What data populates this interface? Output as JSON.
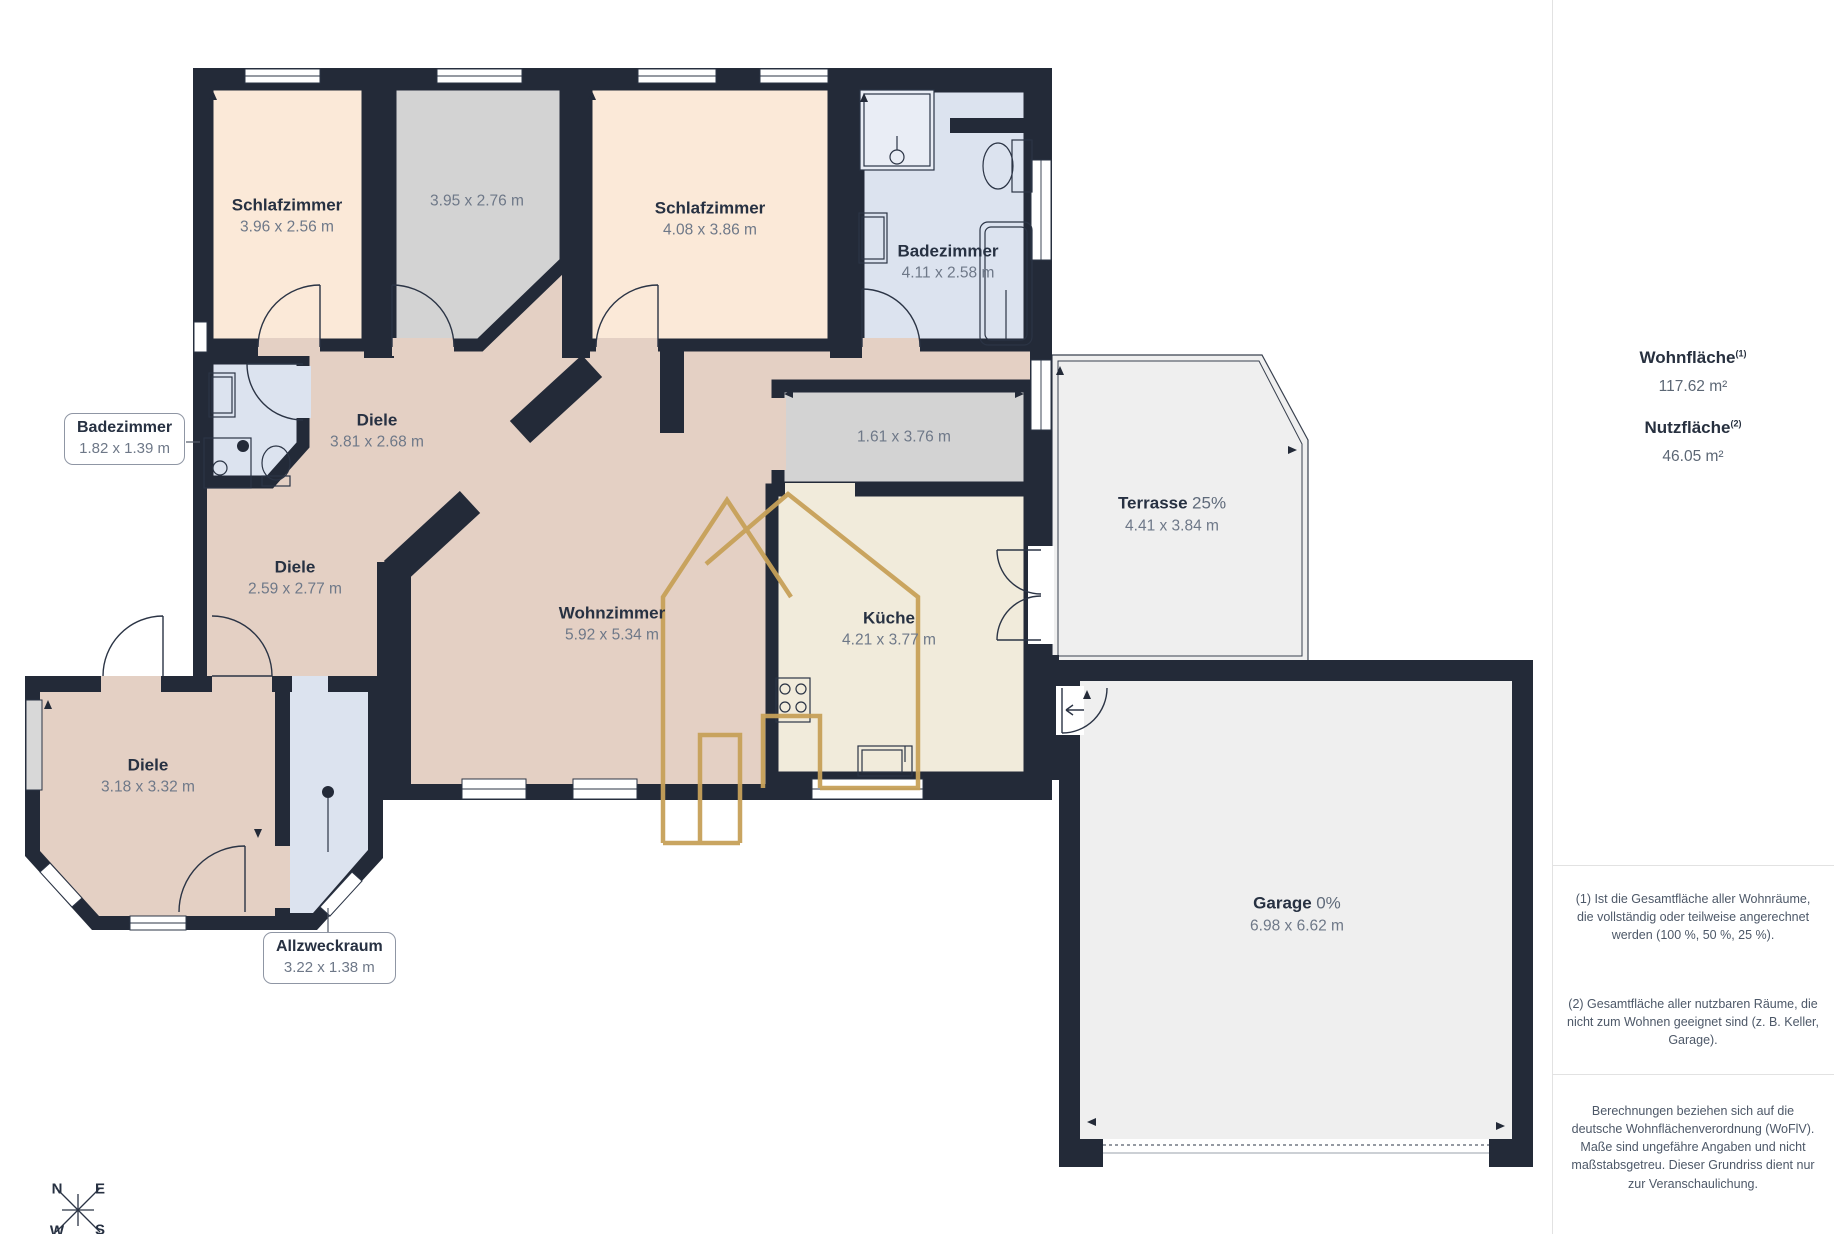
{
  "rooms": [
    {
      "id": "schlafzimmer-1",
      "name": "Schlafzimmer",
      "dims": "3.96 x 2.56 m"
    },
    {
      "id": "raum-oben",
      "name": "",
      "dims": "3.95 x 2.76 m"
    },
    {
      "id": "schlafzimmer-2",
      "name": "Schlafzimmer",
      "dims": "4.08 x 3.86 m"
    },
    {
      "id": "badezimmer-gross",
      "name": "Badezimmer",
      "dims": "4.11 x 2.58 m"
    },
    {
      "id": "badezimmer-klein",
      "name": "Badezimmer",
      "dims": "1.82 x 1.39 m"
    },
    {
      "id": "diele-1",
      "name": "Diele",
      "dims": "3.81 x 2.68 m"
    },
    {
      "id": "diele-2",
      "name": "Diele",
      "dims": "2.59 x 2.77 m"
    },
    {
      "id": "raum-mitte",
      "name": "",
      "dims": "1.61 x 3.76 m"
    },
    {
      "id": "terrasse",
      "name": "Terrasse",
      "pct": "25%",
      "dims": "4.41 x 3.84 m"
    },
    {
      "id": "wohnzimmer",
      "name": "Wohnzimmer",
      "dims": "5.92 x 5.34 m"
    },
    {
      "id": "kueche",
      "name": "Küche",
      "dims": "4.21 x 3.77 m"
    },
    {
      "id": "diele-3",
      "name": "Diele",
      "dims": "3.18 x 3.32 m"
    },
    {
      "id": "allzweckraum",
      "name": "Allzweckraum",
      "dims": "3.22 x 1.38 m"
    },
    {
      "id": "garage",
      "name": "Garage",
      "pct": "0%",
      "dims": "6.98 x 6.62 m"
    }
  ],
  "sidebar": {
    "wohnflaeche_label": "Wohnfläche",
    "wohnflaeche_sup": "(1)",
    "wohnflaeche_value": "117.62 m²",
    "nutzflaeche_label": "Nutzfläche",
    "nutzflaeche_sup": "(2)",
    "nutzflaeche_value": "46.05 m²",
    "footnote1": "(1) Ist die Gesamtfläche aller Wohnräume, die vollständig oder teilweise angerechnet werden (100 %, 50 %, 25 %).",
    "footnote2": "(2) Gesamtfläche aller nutzbaren Räume, die nicht zum Wohnen geeignet sind (z. B. Keller, Garage).",
    "disclaimer": "Berechnungen beziehen sich auf die deutsche Wohnflächenverordnung (WoFlV). Maße sind ungefähre Angaben und nicht maßstabsgetreu. Dieser Grundriss dient nur zur Veranschaulichung."
  },
  "compass": {
    "n": "N",
    "e": "E",
    "s": "S",
    "w": "W"
  },
  "colors": {
    "wall": "#232a38",
    "bedroom": "#fbe9d8",
    "hall": "#e4d0c4",
    "gray_room": "#d3d3d3",
    "bath": "#dce3ef",
    "kitchen": "#f1ebdb",
    "outdoor": "#efefef",
    "watermark_gold": "#c7a159"
  }
}
